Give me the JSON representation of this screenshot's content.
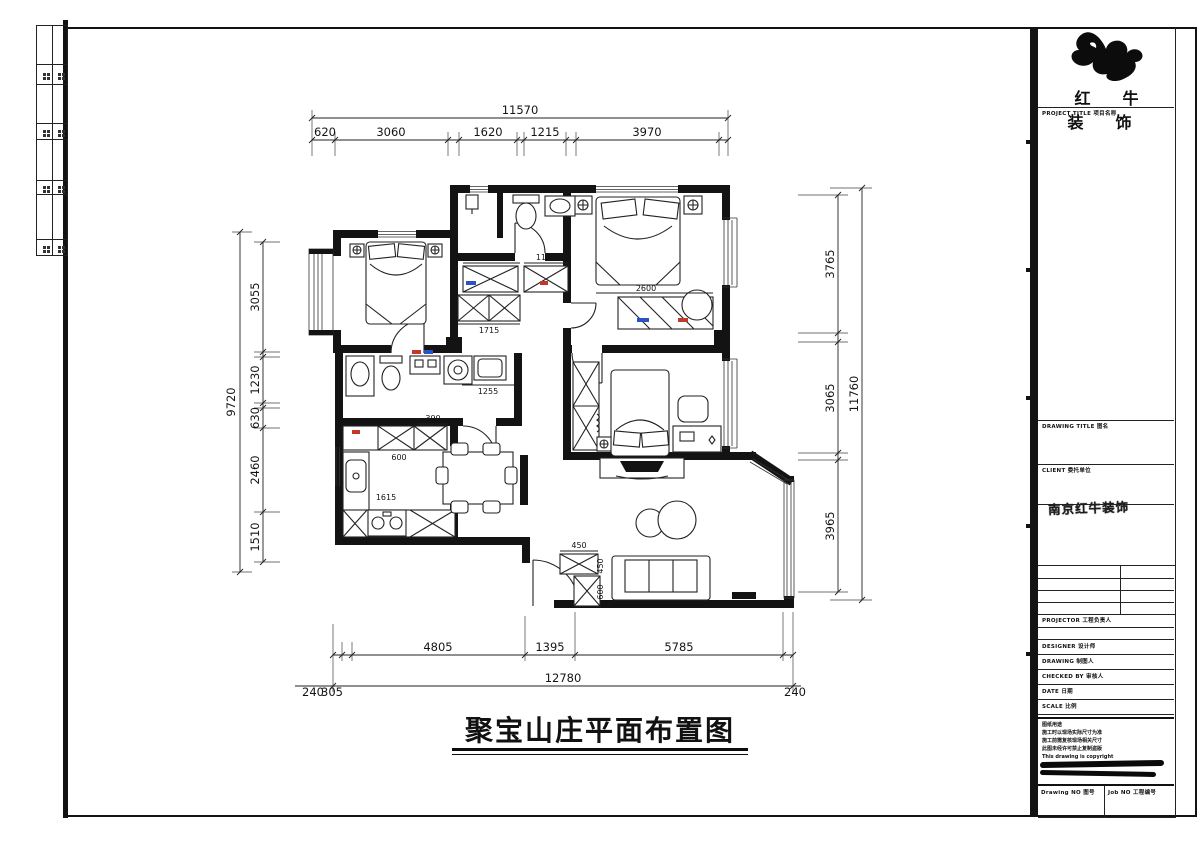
{
  "brand": {
    "logo_text": "红 牛 装 饰",
    "project_label": "PROJECT TITLE 项目名称"
  },
  "titleblock": {
    "drawing_title_label": "DRAWING TITLE 图名",
    "client_label": "CLIENT 委托单位",
    "stamp": "南京红牛装饰",
    "projector_label": "PROJECTOR 工程负责人",
    "designer_label": "DESIGNER 设计师",
    "drawing_label": "DRAWING 制图人",
    "checked_label": "CHECKED BY 审核人",
    "date_label": "DATE 日期",
    "scale_label": "SCALE 比例",
    "notes_title": "图纸用途",
    "notes": [
      "施工时以现场实际尺寸为准",
      "施工前需复核现场相关尺寸",
      "此图未经许可禁止复制盗版",
      "This drawing is copyright"
    ],
    "drawing_no_label": "Drawing NO 图号",
    "job_no_label": "Job NO 工程编号"
  },
  "drawing": {
    "title": "聚宝山庄平面布置图"
  },
  "dims": {
    "top": {
      "overall": "11570",
      "segments": [
        "620",
        "3060",
        "1620",
        "1215",
        "3970"
      ]
    },
    "left": {
      "overall": "9720",
      "segments": [
        "3055",
        "1230",
        "630",
        "2460",
        "1510"
      ]
    },
    "right": {
      "overall": "11760",
      "segments": [
        "3765",
        "3065",
        "3965"
      ]
    },
    "bottom": {
      "overall": "12780",
      "segments": [
        "4805",
        "1395",
        "5785"
      ],
      "offsets": [
        "240",
        "305",
        "240"
      ]
    }
  },
  "plan_labels": {
    "hall_closet_w": "1375",
    "hall_closet_w2": "1120",
    "hall_closet_d": "1715",
    "master_wardrobe_w": "2600",
    "bath_vanity_w": "1255",
    "kitchen_cab_w": "390",
    "kitchen_cab_d": "600",
    "kitchen_counter_w": "1615",
    "entry_cab_w": "450",
    "entry_cab_d": "450",
    "entry_cab_d2": "600"
  }
}
